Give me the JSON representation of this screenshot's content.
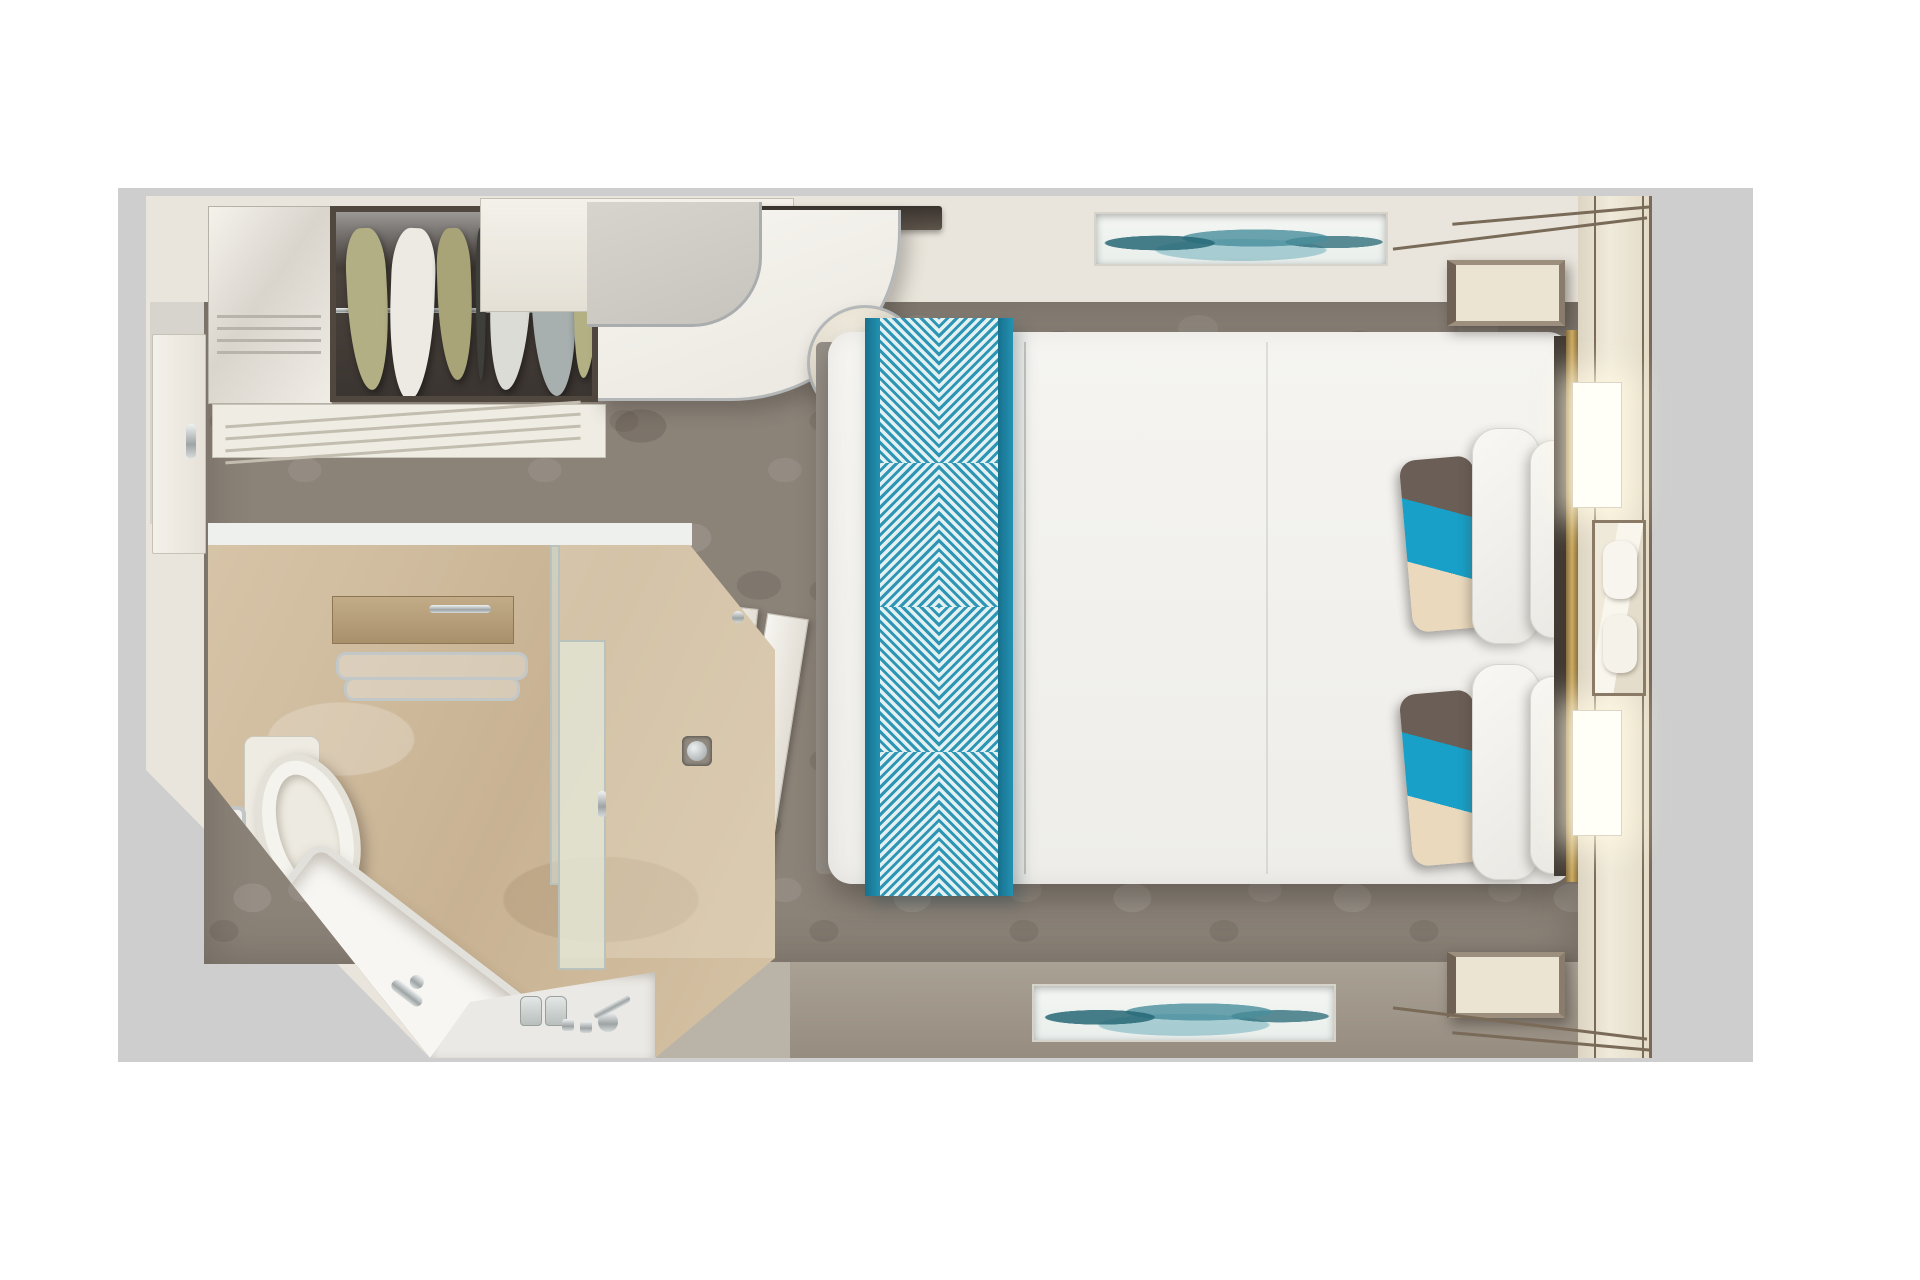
{
  "scene": {
    "title": "Stateroom floor plan — top-down 3D render",
    "rooms": [
      {
        "id": "bedroom",
        "label": "Bedroom"
      },
      {
        "id": "bathroom",
        "label": "Bathroom"
      },
      {
        "id": "entry",
        "label": "Entry"
      }
    ],
    "items": {
      "backdrop": {
        "label": "Gray backdrop"
      },
      "entry_door": {
        "label": "Entry door"
      },
      "wardrobe_doors": {
        "label": "Wardrobe cabinet"
      },
      "closet": {
        "label": "Open closet with hanging clothes"
      },
      "luggage_rack": {
        "label": "Luggage rack shelf"
      },
      "cabinet": {
        "label": "Upper cabinet"
      },
      "tv": {
        "label": "Wall-mounted TV"
      },
      "desk": {
        "label": "Curved vanity desk"
      },
      "desk_cabinet": {
        "label": "Desk cabinet"
      },
      "stool": {
        "label": "Round stool"
      },
      "carpet": {
        "label": "Patterned carpet floor"
      },
      "bed": {
        "label": "Queen bed with white duvet"
      },
      "bed_runner": {
        "label": "Teal diamond-pattern bed runner"
      },
      "accent_pillow": {
        "label": "Teal, brown and cream accent pillow"
      },
      "white_pillow": {
        "label": "White pillow"
      },
      "nightstand_top": {
        "label": "Nightstand"
      },
      "nightstand_bottom": {
        "label": "Nightstand"
      },
      "headboard_wall": {
        "label": "Headboard wall with cream panels"
      },
      "brass_trim": {
        "label": "Brass trim strip"
      },
      "sconce_top": {
        "label": "Lit wall sconce"
      },
      "sconce_bottom": {
        "label": "Lit wall sconce"
      },
      "mirror": {
        "label": "Headboard mirror"
      },
      "artwork_top": {
        "label": "Teal seascape artwork"
      },
      "artwork_bottom": {
        "label": "Teal seascape artwork"
      },
      "bottom_wall": {
        "label": "Foot wall"
      },
      "sliding_door": {
        "label": "Sliding bathroom door"
      },
      "bathroom_floor": {
        "label": "Beige marble bathroom floor"
      },
      "toilet": {
        "label": "Toilet"
      },
      "toilet_paper": {
        "label": "Toilet paper holder"
      },
      "shelf": {
        "label": "Wooden shelf"
      },
      "towel_rack": {
        "label": "Chrome towel rack"
      },
      "bench": {
        "label": "Slatted teak bench"
      },
      "bathtub": {
        "label": "Bathtub"
      },
      "towel_roll": {
        "label": "Rolled towel"
      },
      "tub_faucet": {
        "label": "Tub faucet"
      },
      "sink": {
        "label": "Sink counter"
      },
      "sink_faucet": {
        "label": "Chrome faucet"
      },
      "soap_bottles": {
        "label": "Toiletry bottles"
      },
      "glass_partition": {
        "label": "Glass partition"
      },
      "shower_door": {
        "label": "Frosted shower door"
      },
      "shower_drain": {
        "label": "Shower drain"
      }
    },
    "palette": {
      "backdrop_gray": "#cecece",
      "wall_cream": "#e9e5dc",
      "wall_trim_brown": "#7a6a58",
      "closet_dark": "#4a423c",
      "carpet_taupe": "#8b8278",
      "bathroom_beige": "#d2bda0",
      "bed_white": "#f3f2ef",
      "runner_teal_border": "#1e81a2",
      "runner_stripe_teal": "#2e96b4",
      "pillow_teal": "#18a0c8",
      "pillow_brown": "#6b5e56",
      "pillow_cream": "#ead9bd",
      "chrome": "#b9bcbe",
      "brass": "#cbac62",
      "artwork_teal": "#49919f",
      "bottom_wall_taupe": "#a1988d",
      "sconce_glow": "#fffef7"
    }
  }
}
